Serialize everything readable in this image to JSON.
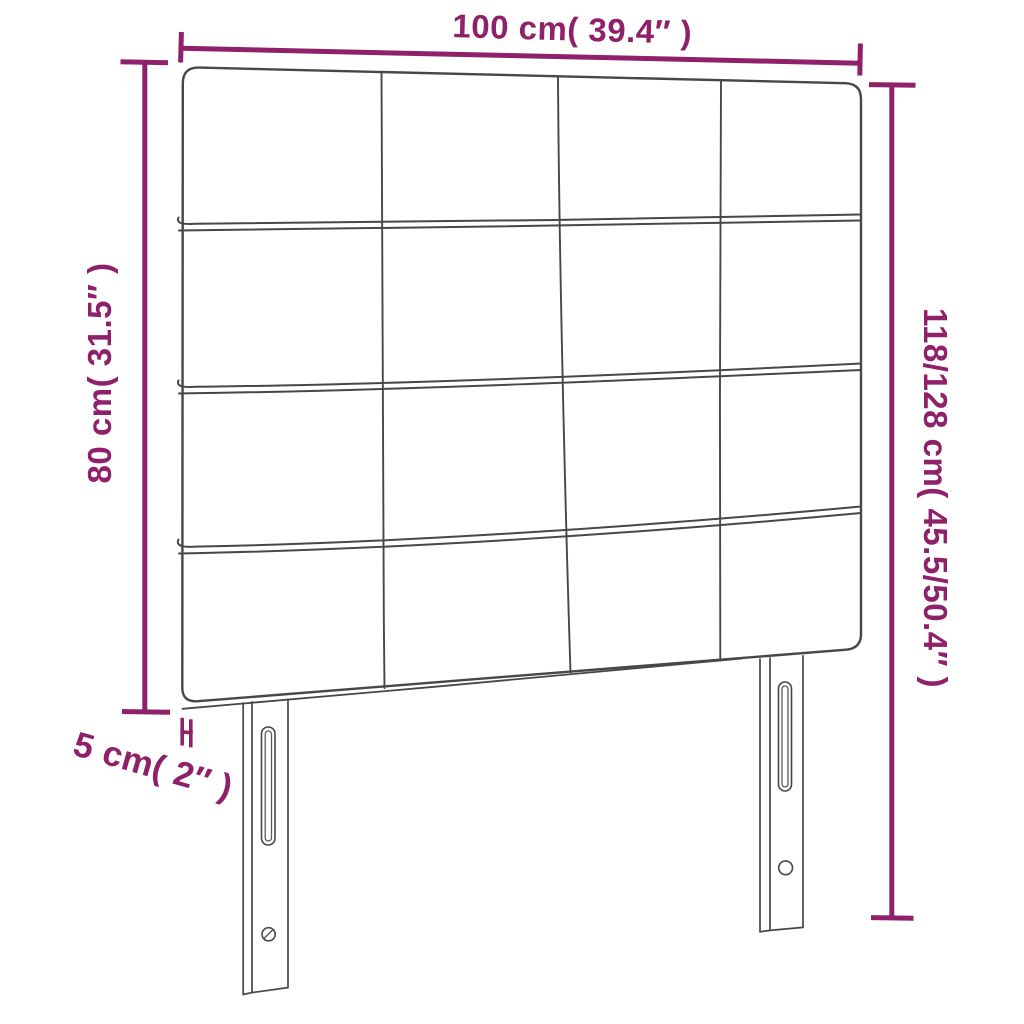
{
  "diagram": {
    "subject": "headboard with 4x4 tufted square panels and two slotted legs",
    "colors": {
      "annotation": "#8e2169",
      "line_art": "#474747",
      "line_art_light": "#5a5a5a",
      "background": "#ffffff"
    },
    "dimensions": {
      "width": {
        "label": "100 cm( 39.4″ )"
      },
      "upholstered_height": {
        "label": "80 cm( 31.5″ )"
      },
      "total_height": {
        "label": "118/128 cm( 45.5/50.4″ )"
      },
      "thickness": {
        "label": "5 cm( 2″ )"
      }
    }
  }
}
